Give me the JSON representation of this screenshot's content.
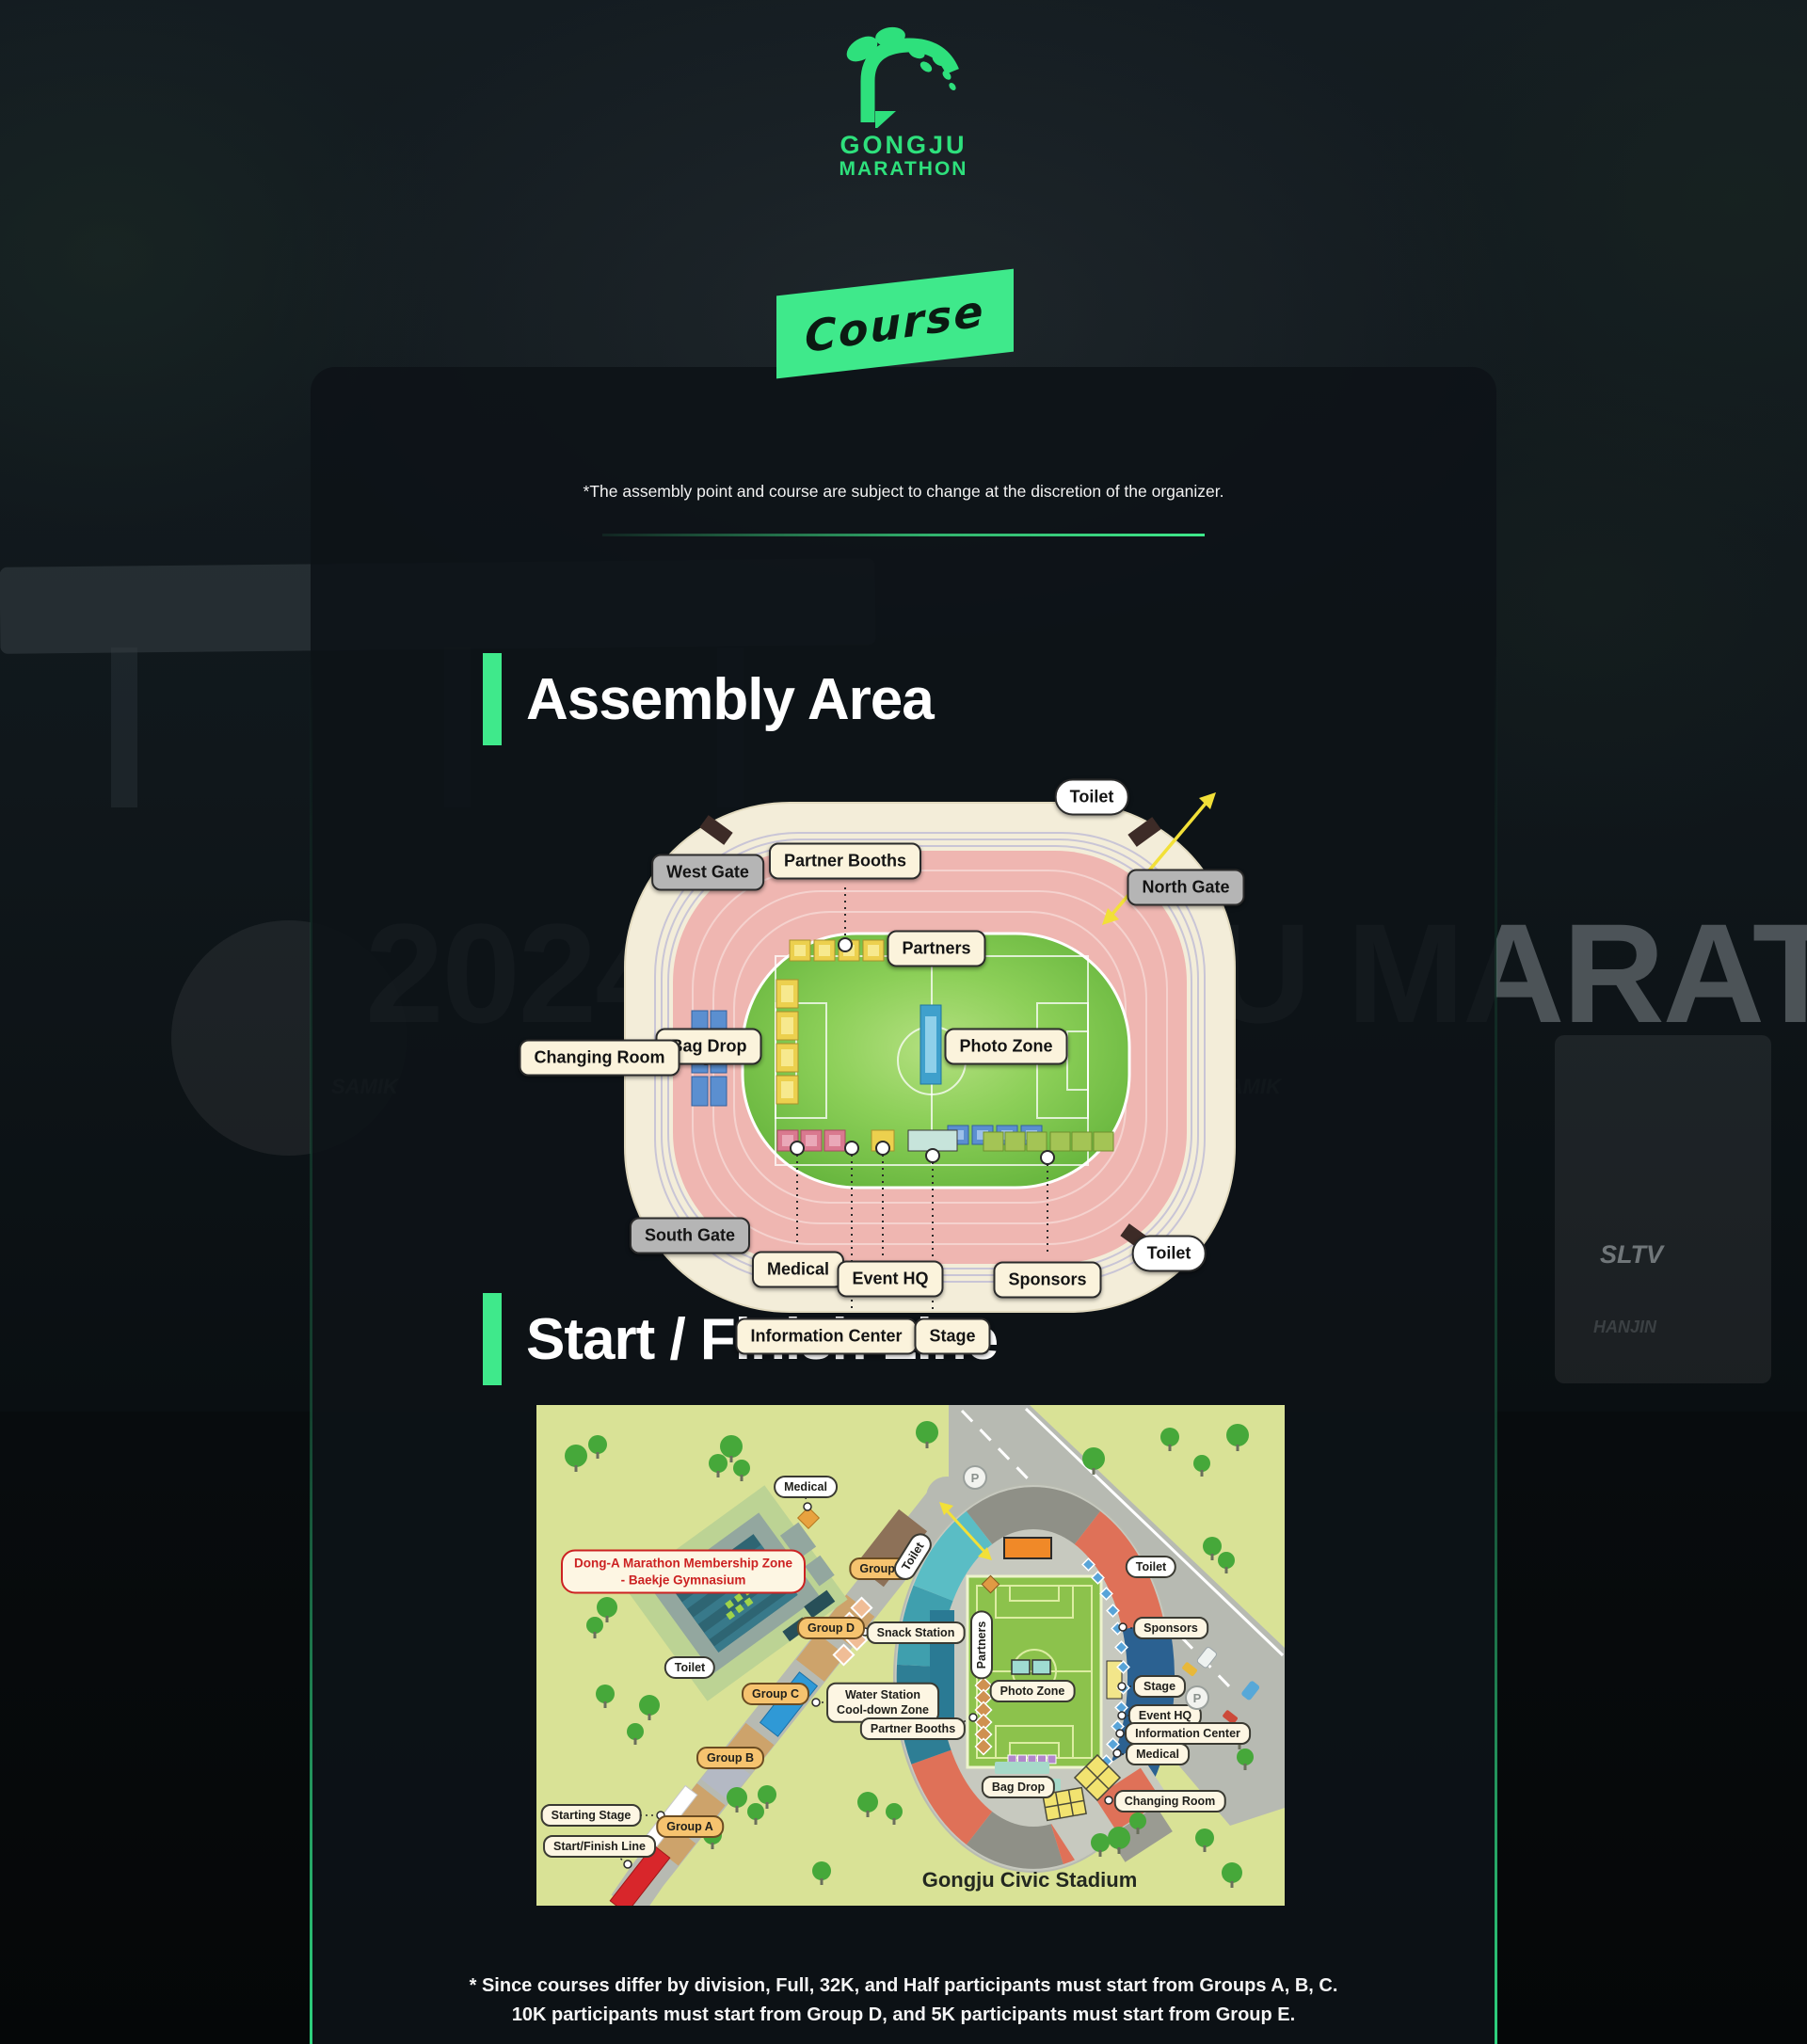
{
  "logo": {
    "name_top": "GONGJU",
    "name_bottom": "MARATHON"
  },
  "course_tag": "Course",
  "disclaimer": "*The assembly point and course are subject to change at the discretion of the organizer.",
  "assembly": {
    "title": "Assembly Area",
    "labels": {
      "toilet_top": "Toilet",
      "west_gate": "West Gate",
      "partner_booths": "Partner Booths",
      "north_gate": "North Gate",
      "partners": "Partners",
      "bag_drop": "Bag Drop",
      "changing_room": "Changing Room",
      "photo_zone": "Photo Zone",
      "south_gate": "South Gate",
      "medical": "Medical",
      "event_hq": "Event HQ",
      "information_center": "Information Center",
      "stage": "Stage",
      "sponsors": "Sponsors",
      "toilet_bottom": "Toilet"
    }
  },
  "start_finish": {
    "title": "Start / Finish Line",
    "stadium_name": "Gongju Civic Stadium",
    "parking": "P",
    "labels": {
      "medical_top": "Medical",
      "donga_line1": "Dong-A Marathon Membership Zone",
      "donga_line2": "- Baekje Gymnasium",
      "group_e": "Group E",
      "toilet_corridor": "Toilet",
      "group_d": "Group D",
      "snack_station": "Snack Station",
      "toilet_gym": "Toilet",
      "group_c": "Group C",
      "water_line1": "Water Station",
      "water_line2": "Cool-down Zone",
      "partner_booths": "Partner Booths",
      "group_b": "Group B",
      "starting_stage": "Starting Stage",
      "group_a": "Group A",
      "start_finish_line": "Start/Finish Line",
      "toilet_stadium": "Toilet",
      "sponsors": "Sponsors",
      "partners": "Partners",
      "photo_zone": "Photo Zone",
      "stage": "Stage",
      "event_hq": "Event HQ",
      "information_center": "Information Center",
      "medical_right": "Medical",
      "bag_drop": "Bag Drop",
      "changing_room": "Changing Room"
    }
  },
  "footer": {
    "line1": "* Since courses differ by division, Full, 32K, and Half participants must start from Groups A, B, C.",
    "line2": "10K participants must start from Group D, and 5K participants must start from Group E."
  },
  "background": {
    "watermark": "2024 GONGJU MARATHON",
    "sign_sltv": "SLTV",
    "sign_hanjin": "HANJIN",
    "sign_samik": "SAMIK"
  },
  "colors": {
    "accent_green": "#3fe98b",
    "logo_green": "#2ee07c",
    "track_pink": "#efb6b1",
    "stadium_cream": "#f3edd9",
    "field_green": "#7dc24f",
    "map_bg": "#d9e296",
    "road_gray": "#b7bab2",
    "stand_blue": "#2b6191",
    "stand_teal": "#3f9fae",
    "stand_salmon": "#df7158",
    "corridor_tan": "#cda36b",
    "water_blue": "#2f99d6",
    "start_red": "#d8262b"
  }
}
